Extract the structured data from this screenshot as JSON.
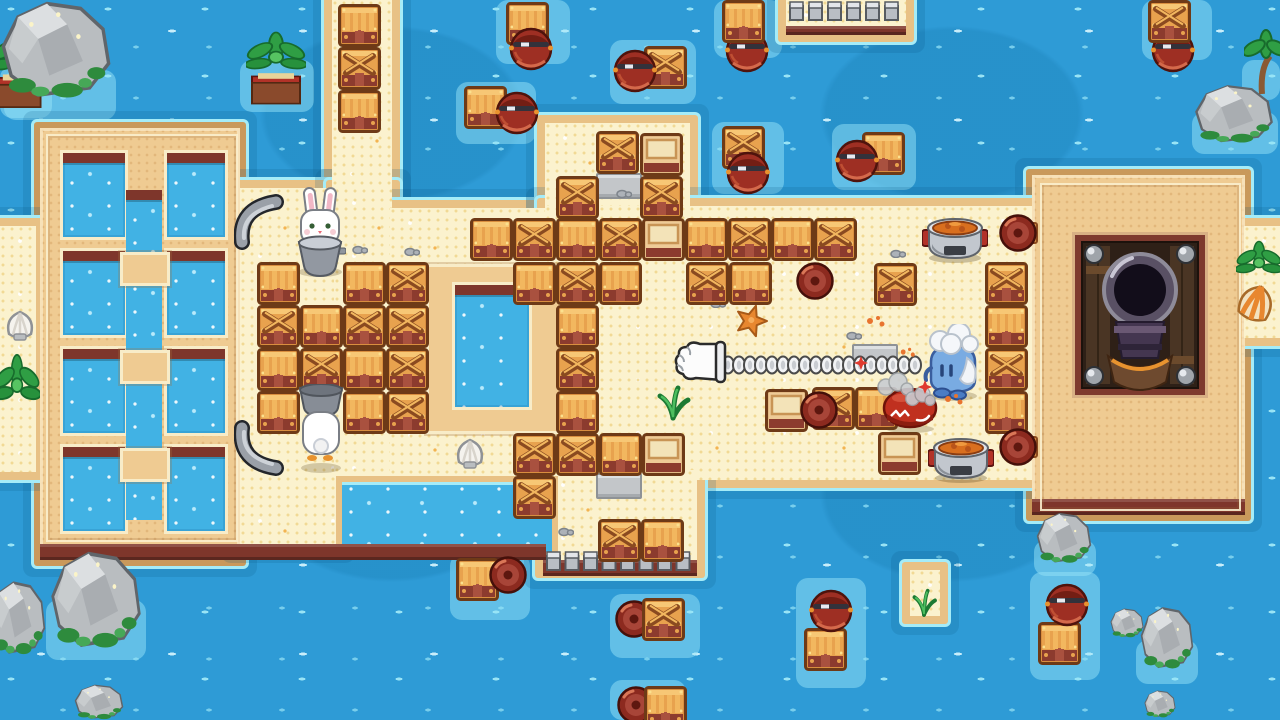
{
  "viewport": {
    "width": 1280,
    "height": 720
  },
  "palette": {
    "water": "#2E9BD6",
    "water_dark": "#1F86BE",
    "water_fleck": "#9FE8F7",
    "cyan_edge": "#A5ECF8",
    "sand": "#FBF2CE",
    "sand_border": "#E8C185",
    "island": "#EFCB92",
    "island_border": "#C9995B",
    "maroon": "#7E362B",
    "pool_frame": "#F8ECC8",
    "pool_water": "#41B2E4",
    "crate_orange": "#E8A24E",
    "crate_light": "#F7C775",
    "crate_dark": "#6E3A17",
    "crate_base": "#8C3B2E",
    "barrel_red": "#9E2F23",
    "barrel_dark": "#4F130C",
    "metal": "#9AA0A8",
    "leaf_green": "#2F9E44",
    "rock_grey": "#B9BDC0",
    "stew_orange": "#D96F1F",
    "character_blue": "#79ABE2",
    "crab_red": "#C0301F",
    "rabbit_white": "#FFFFFF"
  },
  "scene": {
    "glows": [
      {
        "x": 496,
        "y": 0,
        "w": 74,
        "h": 64
      },
      {
        "x": 456,
        "y": 82,
        "w": 80,
        "h": 62
      },
      {
        "x": 610,
        "y": 40,
        "w": 86,
        "h": 64
      },
      {
        "x": 714,
        "y": 0,
        "w": 68,
        "h": 58
      },
      {
        "x": 712,
        "y": 122,
        "w": 72,
        "h": 72
      },
      {
        "x": 832,
        "y": 124,
        "w": 84,
        "h": 66
      },
      {
        "x": 1142,
        "y": 0,
        "w": 70,
        "h": 60
      },
      {
        "x": 450,
        "y": 554,
        "w": 80,
        "h": 66
      },
      {
        "x": 610,
        "y": 594,
        "w": 90,
        "h": 64
      },
      {
        "x": 610,
        "y": 680,
        "w": 76,
        "h": 40
      },
      {
        "x": 796,
        "y": 578,
        "w": 70,
        "h": 110
      },
      {
        "x": 1030,
        "y": 572,
        "w": 70,
        "h": 108
      },
      {
        "x": 4,
        "y": 70,
        "w": 112,
        "h": 50
      },
      {
        "x": 240,
        "y": 60,
        "w": 74,
        "h": 52
      },
      {
        "x": 0,
        "y": 66,
        "w": 52,
        "h": 52
      },
      {
        "x": 46,
        "y": 600,
        "w": 100,
        "h": 60
      },
      {
        "x": 1034,
        "y": 540,
        "w": 62,
        "h": 36
      },
      {
        "x": 1136,
        "y": 640,
        "w": 62,
        "h": 44
      },
      {
        "x": 904,
        "y": 576,
        "w": 44,
        "h": 48
      },
      {
        "x": 1192,
        "y": 112,
        "w": 86,
        "h": 42
      },
      {
        "x": 1242,
        "y": 60,
        "w": 38,
        "h": 40
      }
    ],
    "land": [
      {
        "kind": "island",
        "name": "left-island",
        "x": 40,
        "y": 128,
        "w": 200,
        "h": 432
      },
      {
        "kind": "island",
        "name": "right-island",
        "x": 1032,
        "y": 175,
        "w": 213,
        "h": 340
      },
      {
        "kind": "sand",
        "name": "top-sand-strip",
        "x": 332,
        "y": 0,
        "w": 60,
        "h": 208
      },
      {
        "kind": "sand",
        "name": "bridge-left-column",
        "x": 240,
        "y": 188,
        "w": 96,
        "h": 356
      },
      {
        "kind": "sand",
        "name": "bridge-left",
        "x": 334,
        "y": 188,
        "w": 58,
        "h": 288
      },
      {
        "kind": "sand",
        "name": "bridge-mid-left",
        "x": 390,
        "y": 208,
        "w": 158,
        "h": 268
      },
      {
        "kind": "sand",
        "name": "bridge-top-extension",
        "x": 545,
        "y": 123,
        "w": 145,
        "h": 100
      },
      {
        "kind": "sand",
        "name": "bridge-main",
        "x": 545,
        "y": 206,
        "w": 487,
        "h": 274
      },
      {
        "kind": "sand",
        "name": "bridge-bottom-extension",
        "x": 543,
        "y": 470,
        "w": 154,
        "h": 100
      },
      {
        "kind": "sand",
        "name": "right-edge-strip",
        "x": 1244,
        "y": 226,
        "w": 36,
        "h": 112
      },
      {
        "kind": "sand",
        "name": "left-edge-strip",
        "x": 0,
        "y": 226,
        "w": 36,
        "h": 246
      },
      {
        "kind": "sand",
        "name": "top-dock",
        "x": 786,
        "y": 0,
        "w": 120,
        "h": 34
      },
      {
        "kind": "sand",
        "name": "mini-islet",
        "x": 910,
        "y": 570,
        "w": 30,
        "h": 46
      }
    ],
    "sprites": [
      {
        "t": "pool",
        "x": 60,
        "y": 150,
        "w": 62,
        "h": 84
      },
      {
        "t": "pool",
        "x": 60,
        "y": 248,
        "w": 62,
        "h": 84
      },
      {
        "t": "pool",
        "x": 60,
        "y": 346,
        "w": 62,
        "h": 84
      },
      {
        "t": "pool",
        "x": 60,
        "y": 444,
        "w": 62,
        "h": 84
      },
      {
        "t": "pool",
        "x": 164,
        "y": 150,
        "w": 58,
        "h": 84
      },
      {
        "t": "pool",
        "x": 164,
        "y": 248,
        "w": 58,
        "h": 84
      },
      {
        "t": "pool",
        "x": 164,
        "y": 346,
        "w": 58,
        "h": 84
      },
      {
        "t": "pool",
        "x": 164,
        "y": 444,
        "w": 58,
        "h": 84
      },
      {
        "t": "channel",
        "x": 126,
        "y": 190,
        "w": 36,
        "h": 330
      },
      {
        "t": "pad",
        "x": 120,
        "y": 252,
        "w": 44,
        "h": 28
      },
      {
        "t": "pad",
        "x": 120,
        "y": 350,
        "w": 44,
        "h": 28
      },
      {
        "t": "pad",
        "x": 120,
        "y": 448,
        "w": 44,
        "h": 28
      },
      {
        "t": "pad",
        "x": 426,
        "y": 264,
        "w": 130,
        "h": 164
      },
      {
        "t": "pool",
        "x": 452,
        "y": 282,
        "w": 74,
        "h": 122
      },
      {
        "t": "inlet",
        "x": 336,
        "y": 476,
        "w": 210,
        "h": 70
      },
      {
        "t": "maroon",
        "x": 40,
        "y": 544,
        "w": 506,
        "h": 16
      },
      {
        "t": "maroon",
        "x": 543,
        "y": 560,
        "w": 154,
        "h": 16
      },
      {
        "t": "maroon",
        "x": 1032,
        "y": 499,
        "w": 213,
        "h": 16
      },
      {
        "t": "maroon",
        "x": 786,
        "y": 26,
        "w": 120,
        "h": 9
      },
      {
        "t": "rim",
        "x": 1040,
        "y": 183,
        "w": 197,
        "h": 324
      },
      {
        "t": "rim",
        "x": 46,
        "y": 134,
        "w": 188,
        "h": 404
      },
      {
        "t": "posts",
        "x": 789,
        "y": 0,
        "w": 114,
        "h": 22
      },
      {
        "t": "posts",
        "x": 546,
        "y": 550,
        "w": 148,
        "h": 22
      },
      {
        "t": "cannon",
        "x": 1072,
        "y": 232,
        "w": 136,
        "h": 166
      },
      {
        "t": "tile",
        "x": 596,
        "y": 173,
        "w": 42,
        "h": 22
      },
      {
        "t": "tile",
        "x": 596,
        "y": 473,
        "w": 42,
        "h": 22
      },
      {
        "t": "tile",
        "x": 852,
        "y": 344,
        "w": 42,
        "h": 22
      },
      {
        "t": "pebble",
        "x": 352,
        "y": 244
      },
      {
        "t": "pebble",
        "x": 404,
        "y": 246
      },
      {
        "t": "pebble",
        "x": 616,
        "y": 188
      },
      {
        "t": "pebble",
        "x": 710,
        "y": 298
      },
      {
        "t": "pebble",
        "x": 846,
        "y": 330
      },
      {
        "t": "pebble",
        "x": 520,
        "y": 460
      },
      {
        "t": "pebble",
        "x": 558,
        "y": 526
      },
      {
        "t": "pebble",
        "x": 890,
        "y": 248
      },
      {
        "t": "shellw",
        "x": 452,
        "y": 436
      },
      {
        "t": "shellw",
        "x": 2,
        "y": 308
      },
      {
        "t": "shello",
        "x": 1234,
        "y": 282
      },
      {
        "t": "starfish",
        "x": 734,
        "y": 304
      },
      {
        "t": "sprout",
        "x": 654,
        "y": 372
      },
      {
        "t": "sprout",
        "x": 910,
        "y": 578,
        "w": 28,
        "h": 40
      },
      {
        "t": "planter",
        "x": -8,
        "y": 28,
        "w": 54,
        "h": 86
      },
      {
        "t": "planter",
        "x": 246,
        "y": 30,
        "w": 60,
        "h": 80
      },
      {
        "t": "bush",
        "x": -6,
        "y": 350,
        "w": 46,
        "h": 88
      },
      {
        "t": "bush",
        "x": 1236,
        "y": 238,
        "w": 46,
        "h": 62
      },
      {
        "t": "palmtree",
        "x": 1244,
        "y": 14
      },
      {
        "t": "crate",
        "v": "s",
        "x": 338,
        "y": 4
      },
      {
        "t": "crate",
        "v": "x",
        "x": 338,
        "y": 47
      },
      {
        "t": "crate",
        "v": "s",
        "x": 338,
        "y": 90
      },
      {
        "t": "crate",
        "v": "s",
        "x": 257,
        "y": 262
      },
      {
        "t": "crate",
        "v": "s",
        "x": 343,
        "y": 262
      },
      {
        "t": "crate",
        "v": "x",
        "x": 386,
        "y": 262
      },
      {
        "t": "crate",
        "v": "x",
        "x": 257,
        "y": 305
      },
      {
        "t": "crate",
        "v": "s",
        "x": 300,
        "y": 305
      },
      {
        "t": "crate",
        "v": "x",
        "x": 343,
        "y": 305
      },
      {
        "t": "crate",
        "v": "x",
        "x": 386,
        "y": 305
      },
      {
        "t": "crate",
        "v": "s",
        "x": 257,
        "y": 348
      },
      {
        "t": "crate",
        "v": "x",
        "x": 300,
        "y": 348
      },
      {
        "t": "crate",
        "v": "s",
        "x": 343,
        "y": 348
      },
      {
        "t": "crate",
        "v": "x",
        "x": 386,
        "y": 348
      },
      {
        "t": "crate",
        "v": "s",
        "x": 257,
        "y": 391
      },
      {
        "t": "crate",
        "v": "s",
        "x": 343,
        "y": 391
      },
      {
        "t": "crate",
        "v": "x",
        "x": 386,
        "y": 391
      },
      {
        "t": "crate",
        "v": "x",
        "x": 556,
        "y": 262
      },
      {
        "t": "crate",
        "v": "s",
        "x": 556,
        "y": 305
      },
      {
        "t": "crate",
        "v": "x",
        "x": 556,
        "y": 348
      },
      {
        "t": "crate",
        "v": "s",
        "x": 556,
        "y": 391
      },
      {
        "t": "crate",
        "v": "s",
        "x": 513,
        "y": 262
      },
      {
        "t": "crate",
        "v": "s",
        "x": 599,
        "y": 262
      },
      {
        "t": "crate",
        "v": "x",
        "x": 686,
        "y": 262
      },
      {
        "t": "crate",
        "v": "s",
        "x": 729,
        "y": 262
      },
      {
        "t": "crate",
        "v": "x",
        "x": 874,
        "y": 263
      },
      {
        "t": "crate",
        "v": "s",
        "x": 470,
        "y": 218
      },
      {
        "t": "crate",
        "v": "x",
        "x": 513,
        "y": 218
      },
      {
        "t": "crate",
        "v": "s",
        "x": 556,
        "y": 218
      },
      {
        "t": "crate",
        "v": "x",
        "x": 599,
        "y": 218
      },
      {
        "t": "crate",
        "v": "lid",
        "x": 642,
        "y": 218
      },
      {
        "t": "crate",
        "v": "s",
        "x": 685,
        "y": 218
      },
      {
        "t": "crate",
        "v": "x",
        "x": 728,
        "y": 218
      },
      {
        "t": "crate",
        "v": "s",
        "x": 771,
        "y": 218
      },
      {
        "t": "crate",
        "v": "x",
        "x": 814,
        "y": 218
      },
      {
        "t": "crate",
        "v": "x",
        "x": 596,
        "y": 131
      },
      {
        "t": "crate",
        "v": "lid",
        "x": 640,
        "y": 133
      },
      {
        "t": "crate",
        "v": "x",
        "x": 556,
        "y": 176
      },
      {
        "t": "crate",
        "v": "x",
        "x": 640,
        "y": 176
      },
      {
        "t": "crate",
        "v": "x",
        "x": 985,
        "y": 262
      },
      {
        "t": "crate",
        "v": "s",
        "x": 985,
        "y": 305
      },
      {
        "t": "crate",
        "v": "x",
        "x": 985,
        "y": 348
      },
      {
        "t": "crate",
        "v": "s",
        "x": 985,
        "y": 391
      },
      {
        "t": "crate",
        "v": "x",
        "x": 513,
        "y": 433
      },
      {
        "t": "crate",
        "v": "x",
        "x": 556,
        "y": 433
      },
      {
        "t": "crate",
        "v": "s",
        "x": 599,
        "y": 433
      },
      {
        "t": "crate",
        "v": "lid",
        "x": 642,
        "y": 433
      },
      {
        "t": "crate",
        "v": "x",
        "x": 513,
        "y": 476
      },
      {
        "t": "crate",
        "v": "x",
        "x": 598,
        "y": 519
      },
      {
        "t": "crate",
        "v": "s",
        "x": 641,
        "y": 519
      },
      {
        "t": "crate",
        "v": "x",
        "x": 812,
        "y": 387
      },
      {
        "t": "crate",
        "v": "s",
        "x": 855,
        "y": 387
      },
      {
        "t": "crate",
        "v": "lid",
        "x": 878,
        "y": 432
      },
      {
        "t": "crate",
        "v": "lid",
        "x": 765,
        "y": 389
      },
      {
        "t": "bend",
        "x": 795,
        "y": 260
      },
      {
        "t": "bend",
        "x": 799,
        "y": 389
      },
      {
        "t": "bend",
        "v": "br",
        "x": 998,
        "y": 212
      },
      {
        "t": "bend",
        "v": "br",
        "x": 998,
        "y": 426
      },
      {
        "t": "crate",
        "v": "s",
        "x": 506,
        "y": 2
      },
      {
        "t": "btop",
        "x": 508,
        "y": 24
      },
      {
        "t": "crate",
        "v": "s",
        "x": 464,
        "y": 86
      },
      {
        "t": "btop",
        "x": 494,
        "y": 88
      },
      {
        "t": "crate",
        "v": "x",
        "x": 644,
        "y": 46
      },
      {
        "t": "btop",
        "x": 612,
        "y": 46
      },
      {
        "t": "btop",
        "x": 724,
        "y": 26
      },
      {
        "t": "crate",
        "v": "s",
        "x": 722,
        "y": 0
      },
      {
        "t": "crate",
        "v": "x",
        "x": 722,
        "y": 126
      },
      {
        "t": "btop",
        "x": 725,
        "y": 148
      },
      {
        "t": "crate",
        "v": "s",
        "x": 862,
        "y": 132
      },
      {
        "t": "btop",
        "x": 834,
        "y": 136
      },
      {
        "t": "btop",
        "x": 1150,
        "y": 26
      },
      {
        "t": "crate",
        "v": "x",
        "x": 1148,
        "y": 0
      },
      {
        "t": "crate",
        "v": "s",
        "x": 456,
        "y": 558
      },
      {
        "t": "bend",
        "x": 488,
        "y": 554
      },
      {
        "t": "bend",
        "x": 614,
        "y": 598
      },
      {
        "t": "crate",
        "v": "x",
        "x": 642,
        "y": 598
      },
      {
        "t": "bend",
        "x": 616,
        "y": 684
      },
      {
        "t": "crate",
        "v": "s",
        "x": 644,
        "y": 686
      },
      {
        "t": "crate",
        "v": "s",
        "x": 804,
        "y": 628
      },
      {
        "t": "btop",
        "x": 808,
        "y": 586
      },
      {
        "t": "crate",
        "v": "s",
        "x": 1038,
        "y": 622
      },
      {
        "t": "btop",
        "x": 1044,
        "y": 580
      },
      {
        "t": "pot",
        "x": 922,
        "y": 210
      },
      {
        "t": "pot",
        "x": 928,
        "y": 430
      },
      {
        "t": "hook",
        "x": 234,
        "y": 192
      },
      {
        "t": "hook",
        "v": "flip",
        "x": 234,
        "y": 420
      },
      {
        "t": "chain",
        "x": 722,
        "y": 352,
        "w": 202,
        "h": 26
      },
      {
        "t": "glove",
        "x": 674,
        "y": 336
      },
      {
        "t": "rabbitf",
        "x": 294,
        "y": 186
      },
      {
        "t": "rabbitb",
        "x": 296,
        "y": 384
      },
      {
        "t": "crab",
        "x": 880,
        "y": 386
      },
      {
        "t": "penguin",
        "x": 918,
        "y": 324
      },
      {
        "t": "smoke",
        "x": 876,
        "y": 370
      },
      {
        "t": "smoke",
        "x": 904,
        "y": 384,
        "w": 32,
        "h": 24
      },
      {
        "t": "spark",
        "x": 854,
        "y": 356
      },
      {
        "t": "spark",
        "x": 918,
        "y": 380
      },
      {
        "t": "splat",
        "x": 866,
        "y": 314
      },
      {
        "t": "splat",
        "x": 944,
        "y": 392
      },
      {
        "t": "splat",
        "x": 900,
        "y": 346,
        "w": 16,
        "h": 12
      },
      {
        "t": "rock",
        "x": 0,
        "y": 0,
        "w": 112,
        "h": 100
      },
      {
        "t": "rock",
        "x": 1194,
        "y": 84,
        "w": 80,
        "h": 60
      },
      {
        "t": "rock",
        "x": 50,
        "y": 550,
        "w": 92,
        "h": 100
      },
      {
        "t": "rock",
        "x": -10,
        "y": 580,
        "w": 56,
        "h": 76
      },
      {
        "t": "rock",
        "x": 74,
        "y": 684,
        "w": 50,
        "h": 36
      },
      {
        "t": "rock",
        "x": 1036,
        "y": 512,
        "w": 56,
        "h": 52
      },
      {
        "t": "rock",
        "x": 1140,
        "y": 606,
        "w": 54,
        "h": 64
      },
      {
        "t": "rock",
        "x": 1110,
        "y": 608,
        "w": 34,
        "h": 30
      },
      {
        "t": "rock",
        "x": 1144,
        "y": 690,
        "w": 32,
        "h": 28
      }
    ]
  }
}
